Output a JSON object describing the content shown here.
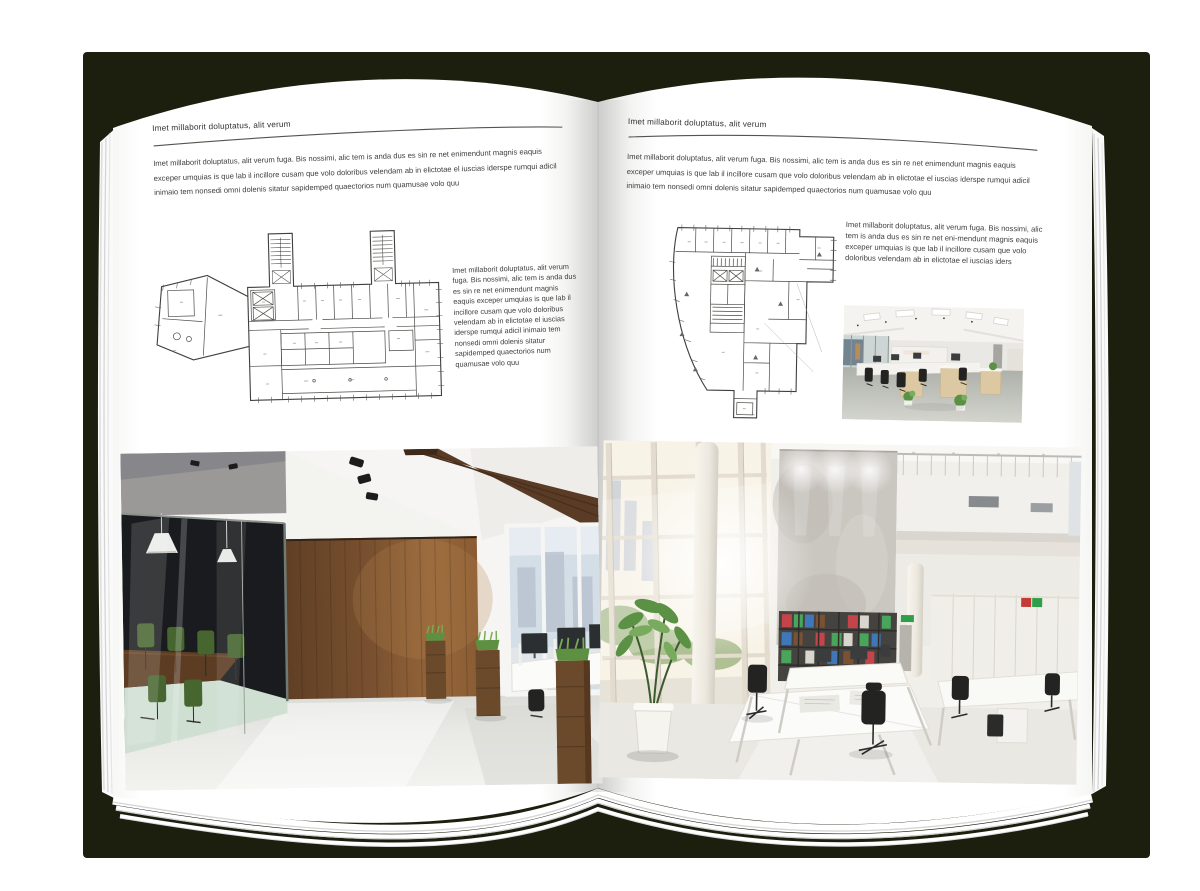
{
  "document_title": "Architecture brochure spread mockup",
  "colors": {
    "cover": "#1c1f0e",
    "page": "#ffffff",
    "ink": "#3d3d3d",
    "heading": "#2f2f2f",
    "rule": "#55544f",
    "plan-line": "#3f3f3c",
    "wood-wall": "#8a5c34",
    "wood-dark": "#5c3d24",
    "beam": "#5a3c26",
    "meeting-room": "#191b1e",
    "chair-green": "#46652f",
    "grass": "#5d9040",
    "planter": "#6b4a2b",
    "window-glass": "#d4dee6",
    "floor-left": "#e7e7e3",
    "sun-glass": "#f8f3e7",
    "tree-green": "#a8bb8d",
    "concrete": "#cac6c0",
    "shelf-dark": "#45433f",
    "binder-red": "#c4444a",
    "binder-green": "#49a45c",
    "binder-blue": "#4077b8",
    "chair-black": "#232321",
    "floor-right": "#eae8e2",
    "carpet": "#b7bab2",
    "desk-wood": "#dcc9a4",
    "plant-green": "#5b9144",
    "exit-green": "#2f9e4a",
    "sign-red": "#c23b34"
  },
  "page_left": {
    "header": "Imet millaborit doluptatus, alit verum",
    "intro": "Imet millaborit doluptatus, alit verum fuga. Bis nossimi, alic tem is anda dus es sin re net enimendunt magnis eaquis exceper umquias is que lab il incillore cusam que volo doloribus velendam ab in elictotae el iuscias iderspe rumqui adicil inimaio tem nonsedi omni dolenis sitatur sapidemped quaectorios num quamusae volo quu",
    "plan_caption": "Imet millaborit doluptatus, alit verum fuga. Bis nossimi, alic tem is anda dus es sin re net enimendunt magnis eaquis exceper umquias is que lab il incillore cusam que volo doloribus velendam ab in elictotae el iuscias iderspe rumqui adicil inimaio tem nonsedi omni dolenis sitatur sapidemped quaectorios num quamusae volo quu"
  },
  "page_right": {
    "header": "Imet millaborit doluptatus, alit verum",
    "intro": "Imet millaborit doluptatus, alit verum fuga. Bis nossimi, alic tem is anda dus es sin re net enimendunt magnis eaquis exceper umquias is que lab il incillore cusam que volo doloribus velendam ab in elictotae el iuscias iderspe rumqui adicil inimaio tem nonsedi omni dolenis sitatur sapidemped quaectorios num quamusae volo quu",
    "plan_caption": "Imet millaborit doluptatus, alit verum fuga. Bis nossimi, alic tem is anda dus es sin re net eni-mendunt magnis eaquis exceper umquias is que lab il incillore cusam que volo doloribus velendam ab in elictotae el iuscias iders"
  },
  "figures": {
    "left_floor_plan": "floor-plan-drawing",
    "right_floor_plan": "floor-plan-drawing",
    "left_photo": "dark-loft-office-photo",
    "right_photo": "bright-atrium-office-photo",
    "small_photo": "open-plan-office-photo"
  }
}
